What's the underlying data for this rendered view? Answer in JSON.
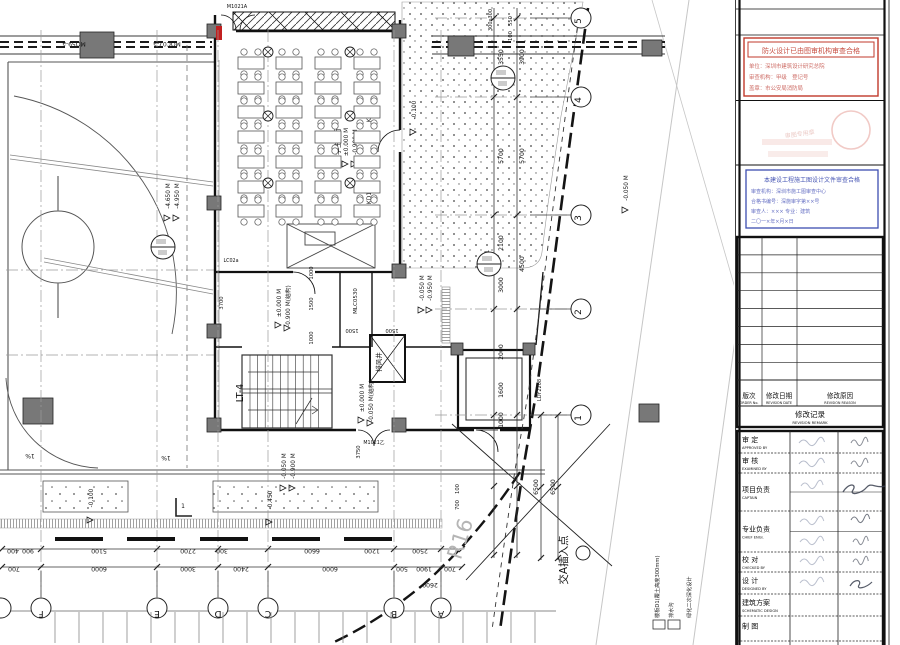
{
  "plan": {
    "grid_letters": [
      {
        "label": "F",
        "x": 41
      },
      {
        "label": "E",
        "x": 157
      },
      {
        "label": "D",
        "x": 218
      },
      {
        "label": "C",
        "x": 268
      },
      {
        "label": "B",
        "x": 394
      },
      {
        "label": "A",
        "x": 441
      }
    ],
    "grid_numbers": [
      {
        "label": "5",
        "y": 18
      },
      {
        "label": "4",
        "y": 97
      },
      {
        "label": "3",
        "y": 215
      },
      {
        "label": "2",
        "y": 309
      },
      {
        "label": "1",
        "y": 415
      }
    ],
    "dims_bottom_upper": [
      {
        "v": "400",
        "x": 13
      },
      {
        "v": "900",
        "x": 28
      },
      {
        "v": "5100",
        "x": 99
      },
      {
        "v": "2700",
        "x": 188
      },
      {
        "v": "300",
        "x": 222
      },
      {
        "v": "6600",
        "x": 312
      },
      {
        "v": "1200",
        "x": 372
      },
      {
        "v": "2500",
        "x": 420
      }
    ],
    "dims_bottom_lower": [
      {
        "v": "700",
        "x": 14
      },
      {
        "v": "6000",
        "x": 99
      },
      {
        "v": "3000",
        "x": 188
      },
      {
        "v": "2400",
        "x": 241
      },
      {
        "v": "6000",
        "x": 330
      },
      {
        "v": "500",
        "x": 402
      },
      {
        "v": "1900",
        "x": 424
      },
      {
        "v": "700",
        "x": 450
      }
    ],
    "dim_extra": {
      "v": "2600",
      "x": 430,
      "y": 583
    },
    "dims_right_inner": [
      {
        "v": "3550",
        "y": 57
      },
      {
        "v": "5700",
        "y": 156
      },
      {
        "v": "2100",
        "y": 243
      },
      {
        "v": "3000",
        "y": 285
      },
      {
        "v": "2000",
        "y": 352
      },
      {
        "v": "1600",
        "y": 390
      },
      {
        "v": "1000",
        "y": 420
      }
    ],
    "dims_right_outer": [
      {
        "v": "3900",
        "y": 57
      },
      {
        "v": "5700",
        "y": 156
      },
      {
        "v": "4500",
        "y": 264
      }
    ],
    "dims_right_low": [
      {
        "v": "6500",
        "x": 538,
        "y": 487
      },
      {
        "v": "6500",
        "x": 555,
        "y": 487
      }
    ],
    "dims_small": [
      {
        "v": "550",
        "x": 512,
        "y": 21
      },
      {
        "v": "100",
        "x": 512,
        "y": 36
      },
      {
        "v": "3700",
        "x": 223,
        "y": 303
      },
      {
        "v": "1000",
        "x": 313,
        "y": 273
      },
      {
        "v": "1500",
        "x": 313,
        "y": 304
      },
      {
        "v": "1000",
        "x": 313,
        "y": 338
      },
      {
        "v": "3750",
        "x": 360,
        "y": 452
      },
      {
        "v": "100",
        "x": 459,
        "y": 489
      },
      {
        "v": "700",
        "x": 459,
        "y": 505
      }
    ],
    "dims_flip": [
      {
        "v": "1500",
        "x": 352,
        "y": 329
      },
      {
        "v": "1500",
        "x": 392,
        "y": 329
      }
    ],
    "elevations": [
      {
        "t": "-4.650 M",
        "x": 170,
        "y": 196
      },
      {
        "t": "-4.950 M",
        "x": 179,
        "y": 196
      },
      {
        "t": "±0.000 M",
        "x": 348,
        "y": 142
      },
      {
        "t": "-0.900 M",
        "x": 357,
        "y": 142
      },
      {
        "t": "±0.000 M",
        "x": 281,
        "y": 303
      },
      {
        "t": "-0.900 M(结构)",
        "x": 290,
        "y": 306
      },
      {
        "t": "-0.050 M",
        "x": 286,
        "y": 466
      },
      {
        "t": "-0.900 M",
        "x": 295,
        "y": 466
      },
      {
        "t": "±0.000 M",
        "x": 364,
        "y": 398
      },
      {
        "t": "-0.050 M(结构)",
        "x": 373,
        "y": 401
      },
      {
        "t": "-0.100",
        "x": 416,
        "y": 110
      },
      {
        "t": "-0.050 M",
        "x": 424,
        "y": 288
      },
      {
        "t": "-0.950 M",
        "x": 432,
        "y": 288
      },
      {
        "t": "-0.050 M",
        "x": 628,
        "y": 188
      },
      {
        "t": "-0.100",
        "x": 93,
        "y": 498
      },
      {
        "t": "-0.450",
        "x": 272,
        "y": 500
      }
    ],
    "labels": [
      {
        "t": "MQ59-a",
        "x": 74,
        "y": 42,
        "rot": 180,
        "s": 6
      },
      {
        "t": "MQC07-a",
        "x": 167,
        "y": 42,
        "rot": 180,
        "s": 6
      },
      {
        "t": "M1021A",
        "x": 237,
        "y": 8,
        "rot": 0,
        "s": 5
      },
      {
        "t": "300x300",
        "x": 492,
        "y": 20,
        "rot": -90,
        "s": 5
      },
      {
        "t": "学生餐厅",
        "x": 340,
        "y": 141,
        "rot": -90,
        "s": 7
      },
      {
        "t": "KD1",
        "x": 371,
        "y": 116,
        "rot": -90,
        "s": 6
      },
      {
        "t": "KD1",
        "x": 371,
        "y": 198,
        "rot": -90,
        "s": 6
      },
      {
        "t": "KD1",
        "x": 489,
        "y": 256,
        "rot": -90,
        "s": 6
      },
      {
        "t": "MLC0530",
        "x": 357,
        "y": 301,
        "rot": -90,
        "s": 5.5
      },
      {
        "t": "排风井",
        "x": 381,
        "y": 362,
        "rot": -90,
        "s": 6.5
      },
      {
        "t": "LDY2208",
        "x": 541,
        "y": 390,
        "rot": -90,
        "s": 5
      },
      {
        "t": "LT-4",
        "x": 243,
        "y": 393,
        "rot": -90,
        "s": 9.5
      },
      {
        "t": "R16",
        "x": 467,
        "y": 541,
        "rot": -72,
        "s": 21,
        "c": "#b5b5b5"
      },
      {
        "t": "交A插入点",
        "x": 567,
        "y": 560,
        "rot": -90,
        "s": 10.5
      },
      {
        "t": "1%",
        "x": 30,
        "y": 454,
        "rot": 180,
        "s": 6
      },
      {
        "t": "1%",
        "x": 166,
        "y": 456,
        "rot": 180,
        "s": 6
      },
      {
        "t": "LC02a",
        "x": 231,
        "y": 262,
        "rot": 0,
        "s": 4.8
      },
      {
        "t": "M1021乙",
        "x": 374,
        "y": 444,
        "rot": 0,
        "s": 4.8
      },
      {
        "t": "1",
        "x": 183,
        "y": 508,
        "rot": 0,
        "s": 6
      },
      {
        "t": "2",
        "x": 503,
        "y": 74,
        "rot": 0,
        "s": 6
      }
    ],
    "legend": {
      "items": [
        "楼板D1(覆土高度300mm)",
        "排水沟",
        "绿化二次深化设计"
      ]
    }
  },
  "panel": {
    "red_stamp": {
      "line1": "防火设计已由图审机构审查合格",
      "line2": "单位：深圳市建筑设计研究总院",
      "line3": "审查机构：甲级　登记号",
      "line4": "盖章：市公安局消防局"
    },
    "seal_text": "审图专用章",
    "blue_stamp": {
      "line1": "本建设工程施工图设计文件审查合格",
      "line2": "审查机构：深圳市施工图审查中心",
      "line3": "合格书编号：深施审字第××号",
      "line4": "审查人：××× 专业：建筑",
      "line5": "二〇一×年×月×日"
    },
    "revision_table": {
      "col_no_zh": "版次",
      "col_no_en": "ORDER No.",
      "col_date_zh": "修改日期",
      "col_date_en": "REVISION DATE",
      "col_reason_zh": "修改原因",
      "col_reason_en": "REVISION REASON",
      "title_zh": "修改记录",
      "title_en": "REVISION REMARK",
      "empty_rows": 8
    },
    "approval_table": {
      "rows": [
        {
          "zh": "审 定",
          "en": "APPROVED BY"
        },
        {
          "zh": "审 核",
          "en": "EXAMINED BY"
        },
        {
          "zh": "项目负责",
          "en": "CAPTAIN"
        },
        {
          "zh": "专业负责",
          "en": "CHIEF ENGI."
        },
        {
          "zh": "校 对",
          "en": "CHECKED BY"
        },
        {
          "zh": "设 计",
          "en": "DESIGNED BY"
        },
        {
          "zh": "建筑方案",
          "en": "SCHEMATIC DESIGN"
        },
        {
          "zh": "制 图",
          "en": ""
        }
      ]
    }
  }
}
